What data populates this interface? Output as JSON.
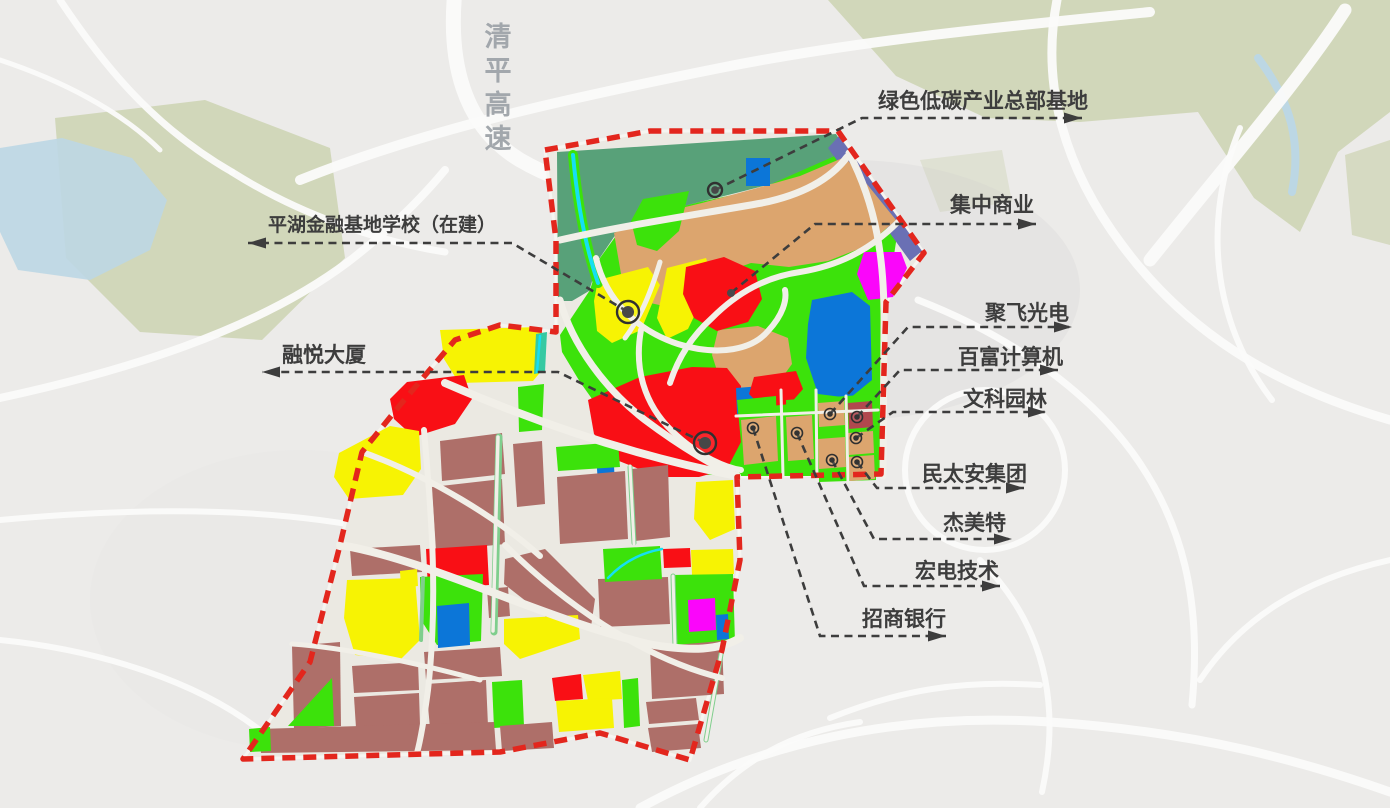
{
  "title": "园区区位规划图",
  "highway": {
    "label": "清平高速",
    "x": 498,
    "y": 46,
    "step": 34,
    "size": 27,
    "color": "#a2a7ac"
  },
  "palette": {
    "bg": "#ecebe9",
    "road_base": "#ebe9e2",
    "road_line": "#f1efe8",
    "bg_road": "#fbfbfa",
    "park": "#cdd3b1",
    "water": "#bcd7e4",
    "seagreen": "#58a179",
    "tan": "#dca56e",
    "green": "#3ce20b",
    "yellow": "#f7f303",
    "red": "#f90f15",
    "brown": "#ae6f69",
    "darkred": "#b1484e",
    "blue": "#0c76d8",
    "magenta": "#fa06fa",
    "cyan": "#16dff2",
    "purple": "#6a70b4",
    "teal": "#35c9a2",
    "street_green": "#7fce8d",
    "boundary": "#e3261d",
    "label_text": "#3d3d3d"
  },
  "boundary_points": "545,150 650,131 838,131 924,253 886,302 881,474 737,477 740,560 722,650 690,760 600,733 500,752 243,759 310,662 340,545 362,452 400,405 455,340 500,325 556,332 556,240",
  "parks": [
    {
      "p": "55,118 205,100 330,148 345,258 262,340 140,332 66,258",
      "o": 0.85
    },
    {
      "p": "828,0 1390,0 1390,112 1338,152 1300,232 1254,198 1198,112 1080,122 986,118 896,76",
      "o": 0.85
    },
    {
      "p": "1345,155 1390,140 1390,245 1352,235",
      "o": 0.7
    },
    {
      "p": "920,160 1002,150 1012,202 940,212",
      "o": 0.4
    }
  ],
  "water_polys": [
    {
      "p": "0,148 62,138 132,158 167,200 150,250 90,280 18,270 0,232",
      "o": 0.9
    }
  ],
  "water_lines": [
    {
      "d": "M1258,58 C1290,100 1302,142 1292,192",
      "w": 8
    }
  ],
  "bg_roads": [
    {
      "d": "M455,-10 C448,60 462,125 520,160 C575,192 640,202 705,196",
      "w": 15
    },
    {
      "d": "M300,180 C430,128 570,98 720,68 C860,40 1010,26 1150,12",
      "w": 10
    },
    {
      "d": "M0,398 C120,372 255,332 348,262 C390,230 420,200 445,170",
      "w": 8
    },
    {
      "d": "M1058,-5 C1040,80 1062,165 1122,245 C1185,330 1270,385 1390,420",
      "w": 9
    },
    {
      "d": "M918,300 C1000,332 1080,382 1132,452 C1183,522 1202,600 1192,705",
      "w": 7
    },
    {
      "d": "M640,808 C760,742 900,712 1050,722 C1200,732 1305,762 1390,792",
      "w": 9
    },
    {
      "d": "M0,640 C100,650 200,682 262,732",
      "w": 6
    },
    {
      "d": "M1240,128 C1202,220 1212,322 1272,400",
      "w": 6
    },
    {
      "d": "M980,560 C1042,622 1062,700 1042,792",
      "w": 6
    },
    {
      "d": "M0,520 C150,506 300,506 420,540",
      "w": 6
    },
    {
      "d": "M1150,260 C1230,160 1300,80 1345,10",
      "w": 13
    },
    {
      "d": "M830,718 C900,690 960,680 1040,685",
      "w": 6
    },
    {
      "d": "M60,0 C100,60 150,125 232,172",
      "w": 7
    },
    {
      "d": "M232,172 C300,215 380,242 445,252",
      "w": 7
    },
    {
      "d": "M0,60 C60,80 120,110 160,150",
      "w": 5
    },
    {
      "d": "M1390,560 C1300,580 1240,620 1200,680",
      "w": 6
    },
    {
      "d": "M905,470 a80,80 0 1,0 160,0 a80,80 0 1,0 -160,0",
      "w": 6
    },
    {
      "d": "M700,808 C740,762 790,732 860,722",
      "w": 6
    }
  ],
  "zones": [
    {
      "c": "seagreen",
      "p": "557,152 836,134 846,150 798,177 744,191 696,203 650,215 616,234 599,259 589,291 572,301 558,301"
    },
    {
      "c": "green",
      "p": "560,335 590,290 600,258 618,233 652,214 700,202 760,189 846,151 899,223 887,300 882,476 736,476 688,474 640,452 607,420 580,382 562,352"
    },
    {
      "c": "purple",
      "p": "839,136 922,251 910,261 828,148"
    },
    {
      "c": "tan",
      "p": "614,233 656,214 702,203 750,190 800,176 845,157 896,220 866,246 828,261 789,267 751,263 717,275 689,291 664,306 641,301 621,274"
    },
    {
      "c": "green",
      "p": "643,199 689,191 679,231 657,251 637,245 631,221"
    },
    {
      "c": "blue",
      "p": "746,158 770,158 770,186 746,186"
    },
    {
      "c": "tan",
      "p": "718,330 758,326 788,338 792,364 776,386 742,392 720,380 712,355"
    },
    {
      "c": "yellow",
      "p": "598,280 648,267 660,285 641,330 612,343 597,331 594,301"
    },
    {
      "c": "yellow",
      "p": "667,268 706,258 713,277 688,329 667,339 657,318"
    },
    {
      "c": "red",
      "p": "686,267 724,257 755,271 762,299 748,322 717,331 694,318 683,294"
    },
    {
      "c": "blue",
      "p": "812,300 852,292 870,306 872,380 850,398 818,394 806,358 808,324"
    },
    {
      "c": "magenta",
      "p": "864,252 901,252 907,268 893,297 868,300 857,274"
    },
    {
      "c": "red",
      "p": "588,400 640,377 692,367 727,368 741,386 742,440 727,469 699,477 659,477 619,461 594,434"
    },
    {
      "c": "blue",
      "p": "736,388 762,386 763,412 737,414"
    },
    {
      "c": "red",
      "p": "754,377 796,371 803,389 790,404 762,407 749,394"
    },
    {
      "c": "blue",
      "p": "596,454 613,451 615,482 598,484"
    },
    {
      "c": "yellow",
      "p": "696,482 733,480 735,529 710,540 694,519"
    },
    {
      "c": "green",
      "p": "737,400 776,396 778,470 744,474"
    },
    {
      "c": "green",
      "p": "786,400 814,398 814,468 788,470"
    },
    {
      "c": "green",
      "p": "818,398 875,394 876,480 819,482"
    },
    {
      "c": "tan",
      "p": "741,420 776,416 778,461 744,465"
    },
    {
      "c": "tan",
      "p": "786,417 812,415 814,459 788,461"
    },
    {
      "c": "tan",
      "p": "818,403 844,401 845,425 819,427"
    },
    {
      "c": "tan",
      "p": "818,439 845,437 846,467 819,469"
    },
    {
      "c": "darkred",
      "p": "848,403 872,401 873,427 849,429"
    },
    {
      "c": "tan",
      "p": "848,433 873,431 874,453 849,455"
    },
    {
      "c": "tan",
      "p": "848,457 874,455 875,479 850,481"
    },
    {
      "c": "yellow",
      "p": "440,330 538,327 546,339 543,369 533,381 459,383 444,359"
    },
    {
      "c": "teal",
      "p": "536,334 547,332 545,372 534,374"
    },
    {
      "c": "red",
      "p": "407,382 464,375 472,399 455,424 414,437 394,419 390,399"
    },
    {
      "c": "green",
      "p": "518,387 544,384 542,430 519,432"
    },
    {
      "c": "yellow",
      "p": "339,453 390,426 419,431 421,469 403,495 349,499 334,477"
    },
    {
      "c": "brown",
      "p": "440,441 502,433 505,474 442,481"
    },
    {
      "c": "brown",
      "p": "513,444 542,441 545,504 517,507"
    },
    {
      "c": "brown",
      "p": "432,487 502,479 505,544 436,551"
    },
    {
      "c": "green",
      "p": "556,447 618,442 620,467 558,471"
    },
    {
      "c": "brown",
      "p": "557,477 625,471 628,539 560,544"
    },
    {
      "c": "brown",
      "p": "632,469 668,465 670,537 635,541"
    },
    {
      "c": "brown",
      "p": "350,549 420,545 422,572 352,576"
    },
    {
      "c": "red",
      "p": "426,549 487,545 489,585 428,589"
    },
    {
      "c": "yellow",
      "p": "400,571 417,569 418,586 401,588"
    },
    {
      "c": "green",
      "p": "420,577 483,574 481,641 437,645 421,620"
    },
    {
      "c": "blue",
      "p": "437,606 469,603 470,645 438,648"
    },
    {
      "c": "brown",
      "p": "505,559 545,549 595,599 591,627 559,627 504,584"
    },
    {
      "c": "brown",
      "p": "598,579 668,577 670,624 600,627"
    },
    {
      "c": "green",
      "p": "603,549 660,546 662,579 605,582"
    },
    {
      "c": "red",
      "p": "663,549 690,548 691,567 664,568"
    },
    {
      "c": "yellow",
      "p": "691,550 733,549 734,574 692,575"
    },
    {
      "c": "green",
      "p": "672,575 733,574 735,643 674,645"
    },
    {
      "c": "magenta",
      "p": "688,600 715,598 716,630 689,632"
    },
    {
      "c": "blue",
      "p": "716,615 728,614 729,639 717,640"
    },
    {
      "c": "yellow",
      "p": "504,619 578,615 580,639 520,659 504,644"
    },
    {
      "c": "yellow",
      "p": "347,580 415,578 420,640 400,660 355,655 344,618"
    },
    {
      "c": "brown",
      "p": "487,589 508,587 510,616 489,618"
    },
    {
      "c": "brown",
      "p": "292,646 340,642 341,726 294,729"
    },
    {
      "c": "green",
      "p": "288,726 332,678 334,726"
    },
    {
      "c": "brown",
      "p": "352,666 418,662 419,690 354,693"
    },
    {
      "c": "brown",
      "p": "354,697 419,693 420,725 356,728"
    },
    {
      "c": "brown",
      "p": "424,652 500,647 502,676 426,680"
    },
    {
      "c": "brown",
      "p": "426,684 486,680 488,726 430,728"
    },
    {
      "c": "green",
      "p": "492,682 522,680 524,726 494,728"
    },
    {
      "c": "red",
      "p": "552,678 581,674 583,699 555,701"
    },
    {
      "c": "yellow",
      "p": "583,675 620,671 622,699 588,701"
    },
    {
      "c": "yellow",
      "p": "556,701 612,698 614,728 559,732"
    },
    {
      "c": "brown",
      "p": "650,647 722,641 724,694 652,699"
    },
    {
      "c": "green",
      "p": "622,680 638,678 640,726 624,728"
    },
    {
      "c": "brown",
      "p": "646,702 696,698 699,720 649,724"
    },
    {
      "c": "brown",
      "p": "648,728 698,724 701,748 652,752"
    },
    {
      "c": "brown",
      "p": "258,729 494,722 496,750 261,753"
    },
    {
      "c": "green",
      "p": "249,729 270,727 271,751 250,752"
    },
    {
      "c": "brown",
      "p": "500,726 552,722 554,748 502,751"
    }
  ],
  "streams": [
    {
      "casing": "green",
      "d": "M573,155 C577,200 585,245 598,283",
      "cw": 10,
      "w": 4
    },
    {
      "casing": "teal",
      "d": "M540,336 L537,372",
      "cw": 0,
      "w": 2.5
    },
    {
      "casing": "none",
      "d": "M608,578 C625,560 645,552 662,549",
      "cw": 0,
      "w": 2.5
    }
  ],
  "street_greens": [
    {
      "d": "M499,437 L494,632",
      "w": 7
    },
    {
      "d": "M630,467 L634,543",
      "w": 5
    },
    {
      "d": "M673,576 L675,646",
      "w": 5
    },
    {
      "d": "M723,643 L706,740",
      "w": 5
    },
    {
      "d": "M423,578 L421,640",
      "w": 4
    }
  ],
  "inner_roads": [
    {
      "d": "M560,240 C620,226 700,214 762,203 C806,194 832,177 847,157",
      "w": 7
    },
    {
      "d": "M849,153 C876,205 885,258 884,330 L883,476",
      "w": 7
    },
    {
      "d": "M898,222 C868,252 836,266 800,272 C766,277 738,292 712,318 C692,336 678,358 670,383",
      "w": 6
    },
    {
      "d": "M560,300 C572,345 606,390 645,420 C685,450 715,466 737,477",
      "w": 7
    },
    {
      "d": "M596,258 C606,300 636,330 678,344 C720,357 753,349 768,331 C783,315 787,300 785,290",
      "w": 6
    },
    {
      "d": "M641,330 C634,368 644,404 672,431 C700,458 728,468 741,470",
      "w": 6
    },
    {
      "d": "M660,262 C650,295 640,318 625,338",
      "w": 5
    },
    {
      "d": "M781,390 L783,476",
      "w": 3
    },
    {
      "d": "M816,390 L817,480",
      "w": 3
    },
    {
      "d": "M846,396 L848,482",
      "w": 3
    },
    {
      "d": "M736,416 L878,410",
      "w": 3
    },
    {
      "d": "M445,383 C530,420 630,455 737,476",
      "w": 8
    },
    {
      "d": "M424,430 C432,520 438,600 428,690 C424,720 420,742 417,753",
      "w": 6
    },
    {
      "d": "M340,545 C430,560 540,618 648,644 C692,652 720,650 740,638",
      "w": 8
    },
    {
      "d": "M505,545 C560,600 640,658 722,678",
      "w": 6
    },
    {
      "d": "M362,452 C430,476 500,520 540,556",
      "w": 6
    },
    {
      "d": "M498,437 L493,631",
      "w": 3.5
    },
    {
      "d": "M630,466 L634,544",
      "w": 3
    },
    {
      "d": "M673,576 L675,647",
      "w": 3
    },
    {
      "d": "M723,643 L706,740",
      "w": 3
    },
    {
      "d": "M292,644 C350,648 420,664 480,680",
      "w": 5
    }
  ],
  "annotations": [
    {
      "id": "green-base",
      "label": "绿色低碳产业总部基地",
      "size": 21,
      "text_x": 878,
      "text_y": 108,
      "segments": [
        [
          715,
          190
        ],
        [
          862,
          118
        ],
        [
          1082,
          118
        ]
      ],
      "marker": {
        "type": "ring-dot",
        "x": 715,
        "y": 190,
        "r": 7
      }
    },
    {
      "id": "central-commerce",
      "label": "集中商业",
      "size": 21,
      "text_x": 950,
      "text_y": 212,
      "segments": [
        [
          731,
          293
        ],
        [
          815,
          224
        ],
        [
          1036,
          224
        ]
      ],
      "marker": {
        "type": "dot",
        "x": 731,
        "y": 293,
        "r": 4
      }
    },
    {
      "id": "school",
      "label": "平湖金融基地学校（在建）",
      "size": 19,
      "text_x": 268,
      "text_y": 231,
      "segments": [
        [
          628,
          312
        ],
        [
          512,
          243
        ],
        [
          248,
          243
        ]
      ],
      "marker": {
        "type": "ring-dot",
        "x": 628,
        "y": 312,
        "r": 11
      }
    },
    {
      "id": "rongyue",
      "label": "融悦大厦",
      "size": 21,
      "text_x": 282,
      "text_y": 362,
      "segments": [
        [
          705,
          443
        ],
        [
          558,
          372
        ],
        [
          262,
          372
        ]
      ],
      "marker": {
        "type": "big-dot",
        "x": 705,
        "y": 443,
        "r": 11
      }
    },
    {
      "id": "jufei",
      "label": "聚飞光电",
      "size": 21,
      "text_x": 985,
      "text_y": 320,
      "segments": [
        [
          830,
          414
        ],
        [
          908,
          327
        ],
        [
          1072,
          327
        ]
      ],
      "marker": {
        "type": "pin",
        "x": 830,
        "y": 414
      }
    },
    {
      "id": "baifu",
      "label": "百富计算机",
      "size": 21,
      "text_x": 958,
      "text_y": 364,
      "segments": [
        [
          857,
          417
        ],
        [
          900,
          370
        ],
        [
          1058,
          370
        ]
      ],
      "marker": {
        "type": "pin",
        "x": 857,
        "y": 417
      }
    },
    {
      "id": "wenke",
      "label": "文科园林",
      "size": 21,
      "text_x": 963,
      "text_y": 406,
      "segments": [
        [
          856,
          438
        ],
        [
          893,
          412
        ],
        [
          1046,
          412
        ]
      ],
      "marker": {
        "type": "pin",
        "x": 856,
        "y": 438
      }
    },
    {
      "id": "mintaian",
      "label": "民太安集团",
      "size": 21,
      "text_x": 922,
      "text_y": 481,
      "segments": [
        [
          857,
          462
        ],
        [
          877,
          488
        ],
        [
          1024,
          488
        ]
      ],
      "marker": {
        "type": "pin",
        "x": 857,
        "y": 462
      }
    },
    {
      "id": "jiemeite",
      "label": "杰美特",
      "size": 21,
      "text_x": 943,
      "text_y": 530,
      "segments": [
        [
          832,
          460
        ],
        [
          874,
          539
        ],
        [
          1012,
          539
        ]
      ],
      "marker": {
        "type": "pin",
        "x": 832,
        "y": 460
      }
    },
    {
      "id": "hongdian",
      "label": "宏电技术",
      "size": 21,
      "text_x": 915,
      "text_y": 578,
      "segments": [
        [
          797,
          433
        ],
        [
          864,
          586
        ],
        [
          1000,
          586
        ]
      ],
      "marker": {
        "type": "pin",
        "x": 797,
        "y": 433
      }
    },
    {
      "id": "zhaoshang",
      "label": "招商银行",
      "size": 21,
      "text_x": 862,
      "text_y": 626,
      "segments": [
        [
          753,
          428
        ],
        [
          820,
          636
        ],
        [
          946,
          636
        ]
      ],
      "marker": {
        "type": "pin",
        "x": 753,
        "y": 428
      }
    }
  ]
}
